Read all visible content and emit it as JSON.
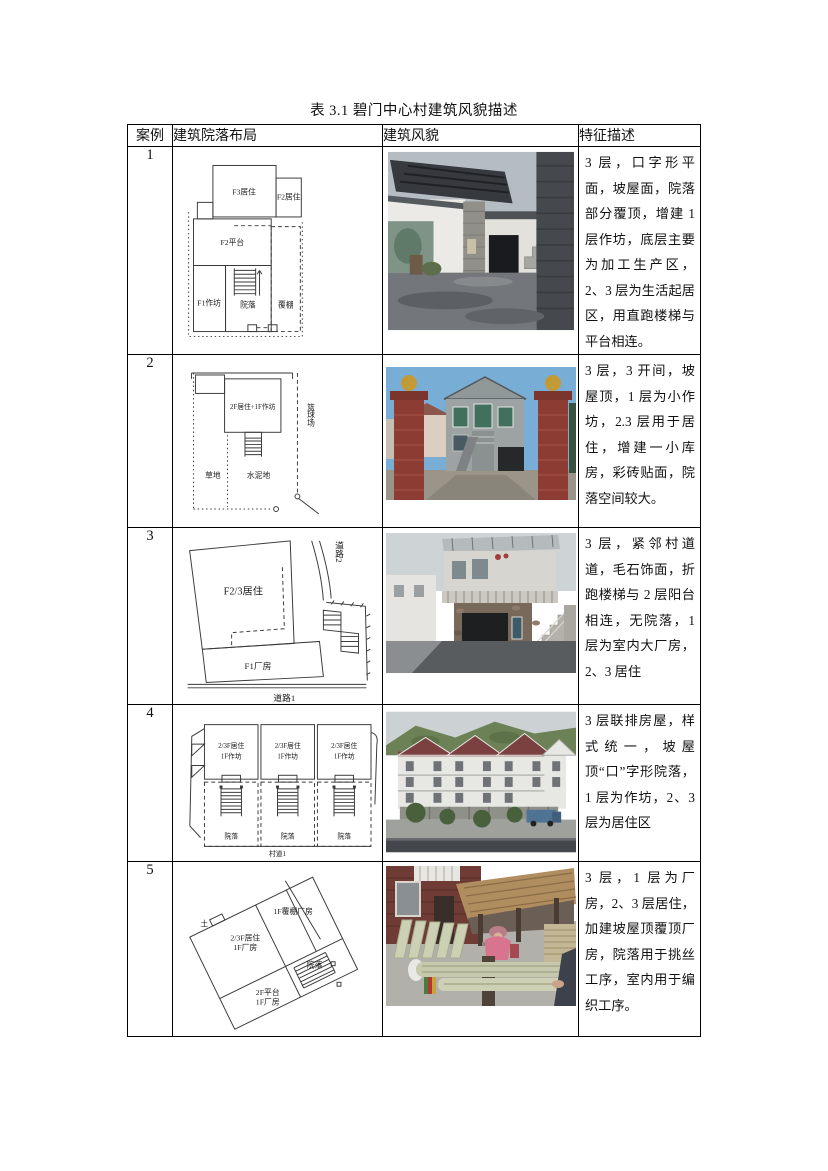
{
  "page": {
    "title": "表 3.1 碧门中心村建筑风貌描述"
  },
  "table": {
    "headers": {
      "case": "案例",
      "layout": "建筑院落布局",
      "appearance": "建筑风貌",
      "features": "特征描述"
    },
    "rows": [
      {
        "case": "1",
        "description": "3 层，口字形平面，坡屋面，院落部分覆顶，增建 1 层作坊，底层主要为加工生产区，2、3 层为生活起居区，用直跑楼梯与平台相连。",
        "diagram": {
          "f3_living": "F3居住",
          "f2_living": "F2居住",
          "f2_platform": "F2平台",
          "f1_workshop": "F1作坊",
          "courtyard": "院落",
          "canopy": "覆棚"
        }
      },
      {
        "case": "2",
        "description": "3 层，3 开间，坡屋顶，1 层为小作坊，2.3 层用于居住，增建一小库房，彩砖贴面，院落空间较大。",
        "diagram": {
          "main": "2F居住+1F作坊",
          "basketball": "篮球场",
          "grass": "草地",
          "cement": "水泥地"
        }
      },
      {
        "case": "3",
        "description": "3 层，紧邻村道道，毛石饰面，折跑楼梯与 2 层阳台相连，无院落，1 层为室内大厂房，2、3 居住",
        "diagram": {
          "living": "F2/3居住",
          "factory": "F1厂房",
          "road1": "道路1",
          "road2": "道路2"
        }
      },
      {
        "case": "4",
        "description": "3 层联排房屋，样式统一，坡屋顶“口”字形院落，1 层为作坊，2、3 层为居住区",
        "diagram": {
          "unit_top1": "2/3F居住",
          "unit_top2": "1F作坊",
          "courtyard": "院落",
          "road": "村道1"
        }
      },
      {
        "case": "5",
        "description": "3 层，1 层为厂房，2、3 层居住，加建坡屋顶覆顶厂房，院落用于挑丝工序，室内用于编织工序。",
        "diagram": {
          "canopy_factory": "1F覆棚厂房",
          "living": "2/3F居住",
          "living_factory": "1F厂房",
          "courtyard": "院落",
          "platform": "2F平台",
          "platform_factory": "1F厂房",
          "soil": "土"
        }
      }
    ]
  }
}
